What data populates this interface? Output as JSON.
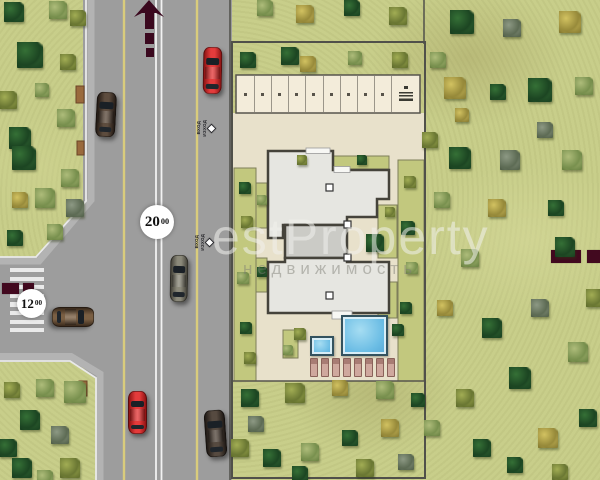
{
  "labels": {
    "main_road_width": {
      "value": "20",
      "sup": "00"
    },
    "side_road_width": {
      "value": "12",
      "sup": "00"
    }
  },
  "watermark": {
    "line1": "estProperty",
    "line2": "недвижимость"
  },
  "entrance_markers": [
    {
      "line1": "ВХОД",
      "line2": "ИЗХОД"
    },
    {
      "line1": "ВХОД",
      "line2": "ИЗХОД"
    }
  ],
  "colors": {
    "grass": "#c8ce8a",
    "road": "#9d9d9d",
    "plot_paving": "#e8e1cb",
    "parking_stalls": "#f3ecda",
    "building_fill": "#e6e6e1",
    "building_stroke": "#45433b",
    "pool_water": "#6fc0e6",
    "marking_maroon": "#42091f",
    "lane_line_yellow": "#d9cc7c",
    "center_line_white": "#f2f2f2"
  },
  "parking": {
    "spaces": 9,
    "has_utility_stall": true
  },
  "loungers": {
    "count": 8
  },
  "zebra": {
    "stripes": 8
  },
  "cars": [
    {
      "x": 203,
      "y": 47,
      "w": 19,
      "h": 47,
      "rot": 1,
      "c1": "#8e1414",
      "c2": "#e43c3c"
    },
    {
      "x": 96,
      "y": 92,
      "w": 20,
      "h": 45,
      "rot": 3,
      "c1": "#241b15",
      "c2": "#5d4c3e"
    },
    {
      "x": 170,
      "y": 255,
      "w": 18,
      "h": 47,
      "rot": 1,
      "c1": "#45433a",
      "c2": "#8b897a"
    },
    {
      "x": 128,
      "y": 391,
      "w": 19,
      "h": 43,
      "rot": 0,
      "c1": "#8e1212",
      "c2": "#e43b3b"
    },
    {
      "x": 205,
      "y": 410,
      "w": 21,
      "h": 47,
      "rot": -4,
      "c1": "#201a16",
      "c2": "#564a40"
    },
    {
      "x": 63,
      "y": 296,
      "w": 20,
      "h": 42,
      "rot": 90,
      "c1": "#3a2a1c",
      "c2": "#7a5f43"
    }
  ],
  "trees": [
    [
      14,
      12,
      "dark",
      10
    ],
    [
      58,
      10,
      "pale",
      9
    ],
    [
      78,
      18,
      "olive",
      8
    ],
    [
      30,
      55,
      "dark",
      13
    ],
    [
      68,
      62,
      "olive",
      8
    ],
    [
      8,
      100,
      "olive",
      9
    ],
    [
      42,
      90,
      "pale",
      7
    ],
    [
      20,
      138,
      "dark",
      11
    ],
    [
      66,
      118,
      "pale",
      9
    ],
    [
      24,
      158,
      "dark",
      12
    ],
    [
      70,
      178,
      "pale",
      9
    ],
    [
      45,
      198,
      "pale",
      10
    ],
    [
      75,
      208,
      "gray",
      9
    ],
    [
      20,
      200,
      "yellow",
      8
    ],
    [
      55,
      232,
      "pale",
      8
    ],
    [
      15,
      238,
      "dark",
      8
    ],
    [
      12,
      390,
      "olive",
      8
    ],
    [
      45,
      388,
      "pale",
      9
    ],
    [
      75,
      392,
      "pale",
      11
    ],
    [
      30,
      420,
      "dark",
      10
    ],
    [
      8,
      448,
      "dark",
      9
    ],
    [
      60,
      435,
      "gray",
      9
    ],
    [
      22,
      468,
      "dark",
      10
    ],
    [
      70,
      468,
      "olive",
      10
    ],
    [
      45,
      478,
      "pale",
      8
    ],
    [
      265,
      8,
      "pale",
      8
    ],
    [
      305,
      14,
      "yellow",
      9
    ],
    [
      352,
      8,
      "dark",
      8
    ],
    [
      398,
      16,
      "olive",
      9
    ],
    [
      248,
      60,
      "dark",
      8
    ],
    [
      290,
      56,
      "dark",
      9
    ],
    [
      308,
      64,
      "yellow",
      8
    ],
    [
      355,
      58,
      "pale",
      7
    ],
    [
      400,
      60,
      "olive",
      8
    ],
    [
      462,
      22,
      "dark",
      12
    ],
    [
      512,
      28,
      "gray",
      9
    ],
    [
      570,
      22,
      "yellow",
      11
    ],
    [
      438,
      60,
      "pale",
      8
    ],
    [
      455,
      88,
      "yellow",
      11
    ],
    [
      498,
      92,
      "dark",
      8
    ],
    [
      540,
      90,
      "dark",
      12
    ],
    [
      584,
      86,
      "pale",
      9
    ],
    [
      462,
      115,
      "yellow",
      7
    ],
    [
      545,
      130,
      "gray",
      8
    ],
    [
      430,
      140,
      "olive",
      8
    ],
    [
      460,
      158,
      "dark",
      11
    ],
    [
      510,
      160,
      "gray",
      10
    ],
    [
      572,
      160,
      "pale",
      10
    ],
    [
      497,
      208,
      "yellow",
      9
    ],
    [
      556,
      208,
      "dark",
      8
    ],
    [
      442,
      200,
      "pale",
      8
    ],
    [
      565,
      247,
      "dark",
      10
    ],
    [
      470,
      258,
      "pale",
      9
    ],
    [
      595,
      298,
      "olive",
      9
    ],
    [
      540,
      308,
      "gray",
      9
    ],
    [
      492,
      328,
      "dark",
      10
    ],
    [
      445,
      308,
      "yellow",
      8
    ],
    [
      578,
      352,
      "pale",
      10
    ],
    [
      520,
      378,
      "dark",
      11
    ],
    [
      465,
      398,
      "olive",
      9
    ],
    [
      588,
      418,
      "dark",
      9
    ],
    [
      548,
      438,
      "yellow",
      10
    ],
    [
      482,
      448,
      "dark",
      9
    ],
    [
      432,
      428,
      "pale",
      8
    ],
    [
      515,
      465,
      "dark",
      8
    ],
    [
      560,
      472,
      "olive",
      8
    ],
    [
      250,
      398,
      "dark",
      9
    ],
    [
      295,
      393,
      "olive",
      10
    ],
    [
      340,
      388,
      "yellow",
      8
    ],
    [
      385,
      390,
      "pale",
      9
    ],
    [
      240,
      448,
      "olive",
      9
    ],
    [
      272,
      458,
      "dark",
      9
    ],
    [
      310,
      452,
      "pale",
      9
    ],
    [
      350,
      438,
      "dark",
      8
    ],
    [
      390,
      428,
      "yellow",
      9
    ],
    [
      300,
      474,
      "dark",
      8
    ],
    [
      256,
      424,
      "gray",
      8
    ],
    [
      406,
      462,
      "gray",
      8
    ],
    [
      365,
      468,
      "olive",
      9
    ],
    [
      418,
      400,
      "dark",
      7
    ],
    [
      245,
      188,
      "dark",
      6
    ],
    [
      247,
      222,
      "olive",
      6
    ],
    [
      243,
      278,
      "pale",
      6
    ],
    [
      246,
      328,
      "dark",
      6
    ],
    [
      250,
      358,
      "olive",
      6
    ],
    [
      410,
      182,
      "olive",
      6
    ],
    [
      408,
      228,
      "dark",
      7
    ],
    [
      412,
      268,
      "pale",
      6
    ],
    [
      406,
      308,
      "dark",
      6
    ],
    [
      375,
      243,
      "dark",
      9
    ],
    [
      390,
      212,
      "olive",
      5
    ],
    [
      362,
      160,
      "dark",
      5
    ],
    [
      302,
      160,
      "olive",
      5
    ],
    [
      300,
      334,
      "olive",
      6
    ],
    [
      398,
      330,
      "dark",
      6
    ],
    [
      288,
      350,
      "pale",
      5
    ],
    [
      262,
      200,
      "pale",
      5
    ],
    [
      262,
      272,
      "dark",
      5
    ]
  ]
}
